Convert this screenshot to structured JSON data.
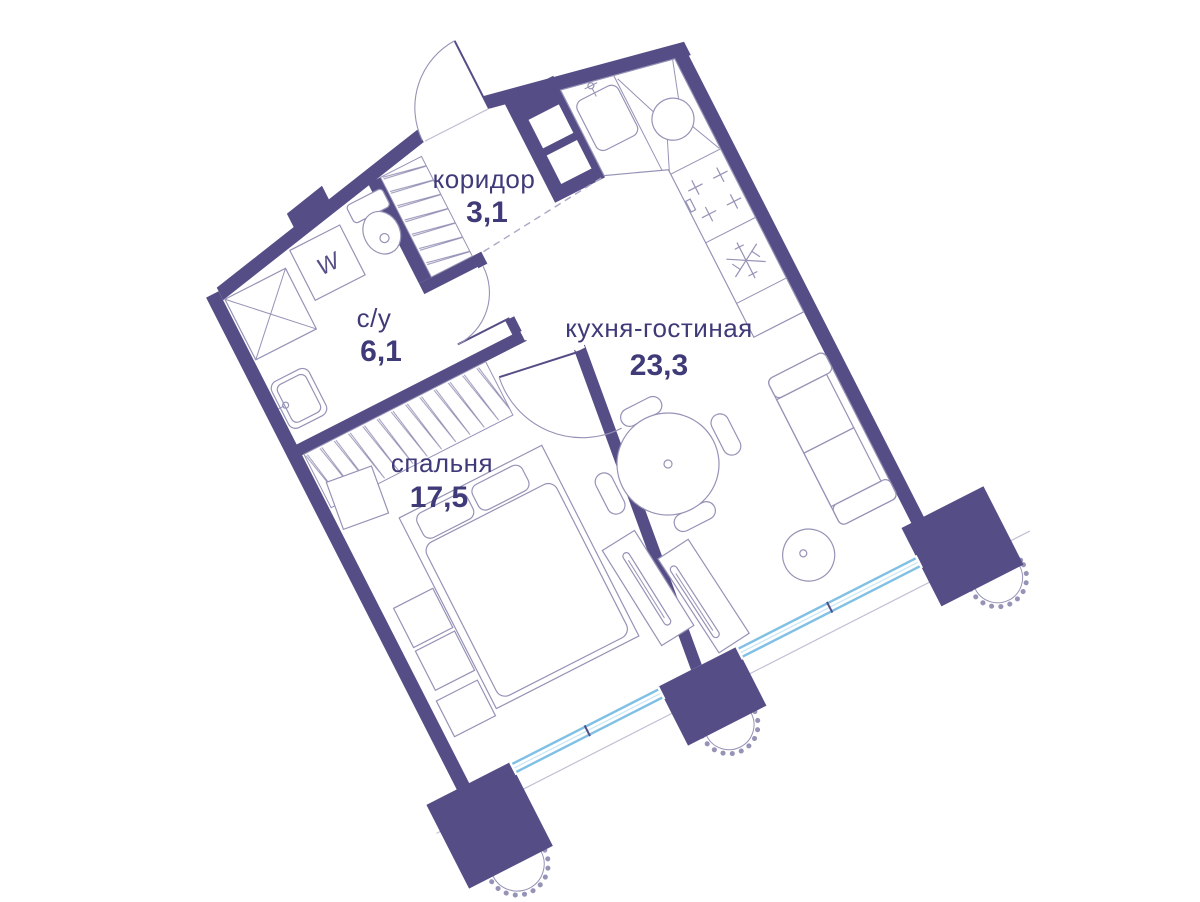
{
  "plan": {
    "type": "apartment-floor-plan",
    "rotation_deg": -27
  },
  "rooms": {
    "corridor": {
      "name": "коридор",
      "area": "3,1"
    },
    "bathroom": {
      "name": "с/у",
      "area": "6,1"
    },
    "kitchen_living": {
      "name": "кухня-гостиная",
      "area": "23,3"
    },
    "bedroom": {
      "name": "спальня",
      "area": "17,5"
    }
  },
  "appliances": {
    "washer_label": "W"
  },
  "icons": [
    "entrance-door-arc",
    "bathroom-door-arc",
    "bedroom-door-arc",
    "shower-icon",
    "washing-machine-icon",
    "toilet-icon",
    "bathroom-sink-icon",
    "wardrobe-hatch",
    "closet-hatch",
    "bed-icon",
    "nightstand-icon",
    "bench-icon",
    "kitchen-counter",
    "kitchen-sink-icon",
    "corner-sink-icon",
    "stove-icon",
    "fridge-snowflake-icon",
    "dining-table-icon",
    "chair-icon",
    "sofa-icon",
    "pouf-icon",
    "tv-console-icon",
    "window-band",
    "wall-pier",
    "scallop-ornament"
  ],
  "colors": {
    "wall": "#554e86",
    "line": "#9593b6",
    "blue": "#7fc0e4",
    "bluelight": "#c9e7f5",
    "text": "#3f3a78",
    "dash": "#a9a7c4",
    "sill": "#c2c0d4"
  }
}
